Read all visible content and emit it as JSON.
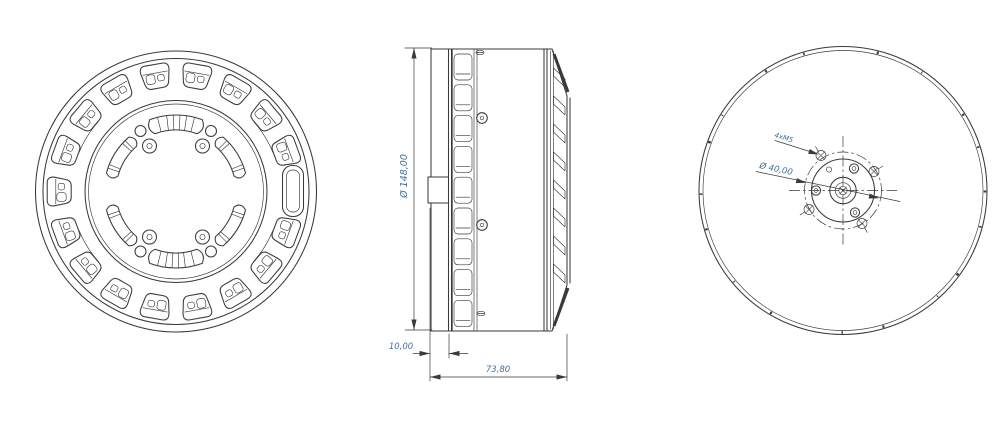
{
  "dimensions": {
    "front_face_diameter": "Ø 148,00",
    "shaft_protrusion": "10,00",
    "overall_length": "73,80",
    "thread_callout": "4xM5",
    "bolt_circle_diameter": "Ø 40,00"
  },
  "colors": {
    "line": "#3a3a3a",
    "dimension_text": "#3f6f9c",
    "background": "#ffffff"
  }
}
